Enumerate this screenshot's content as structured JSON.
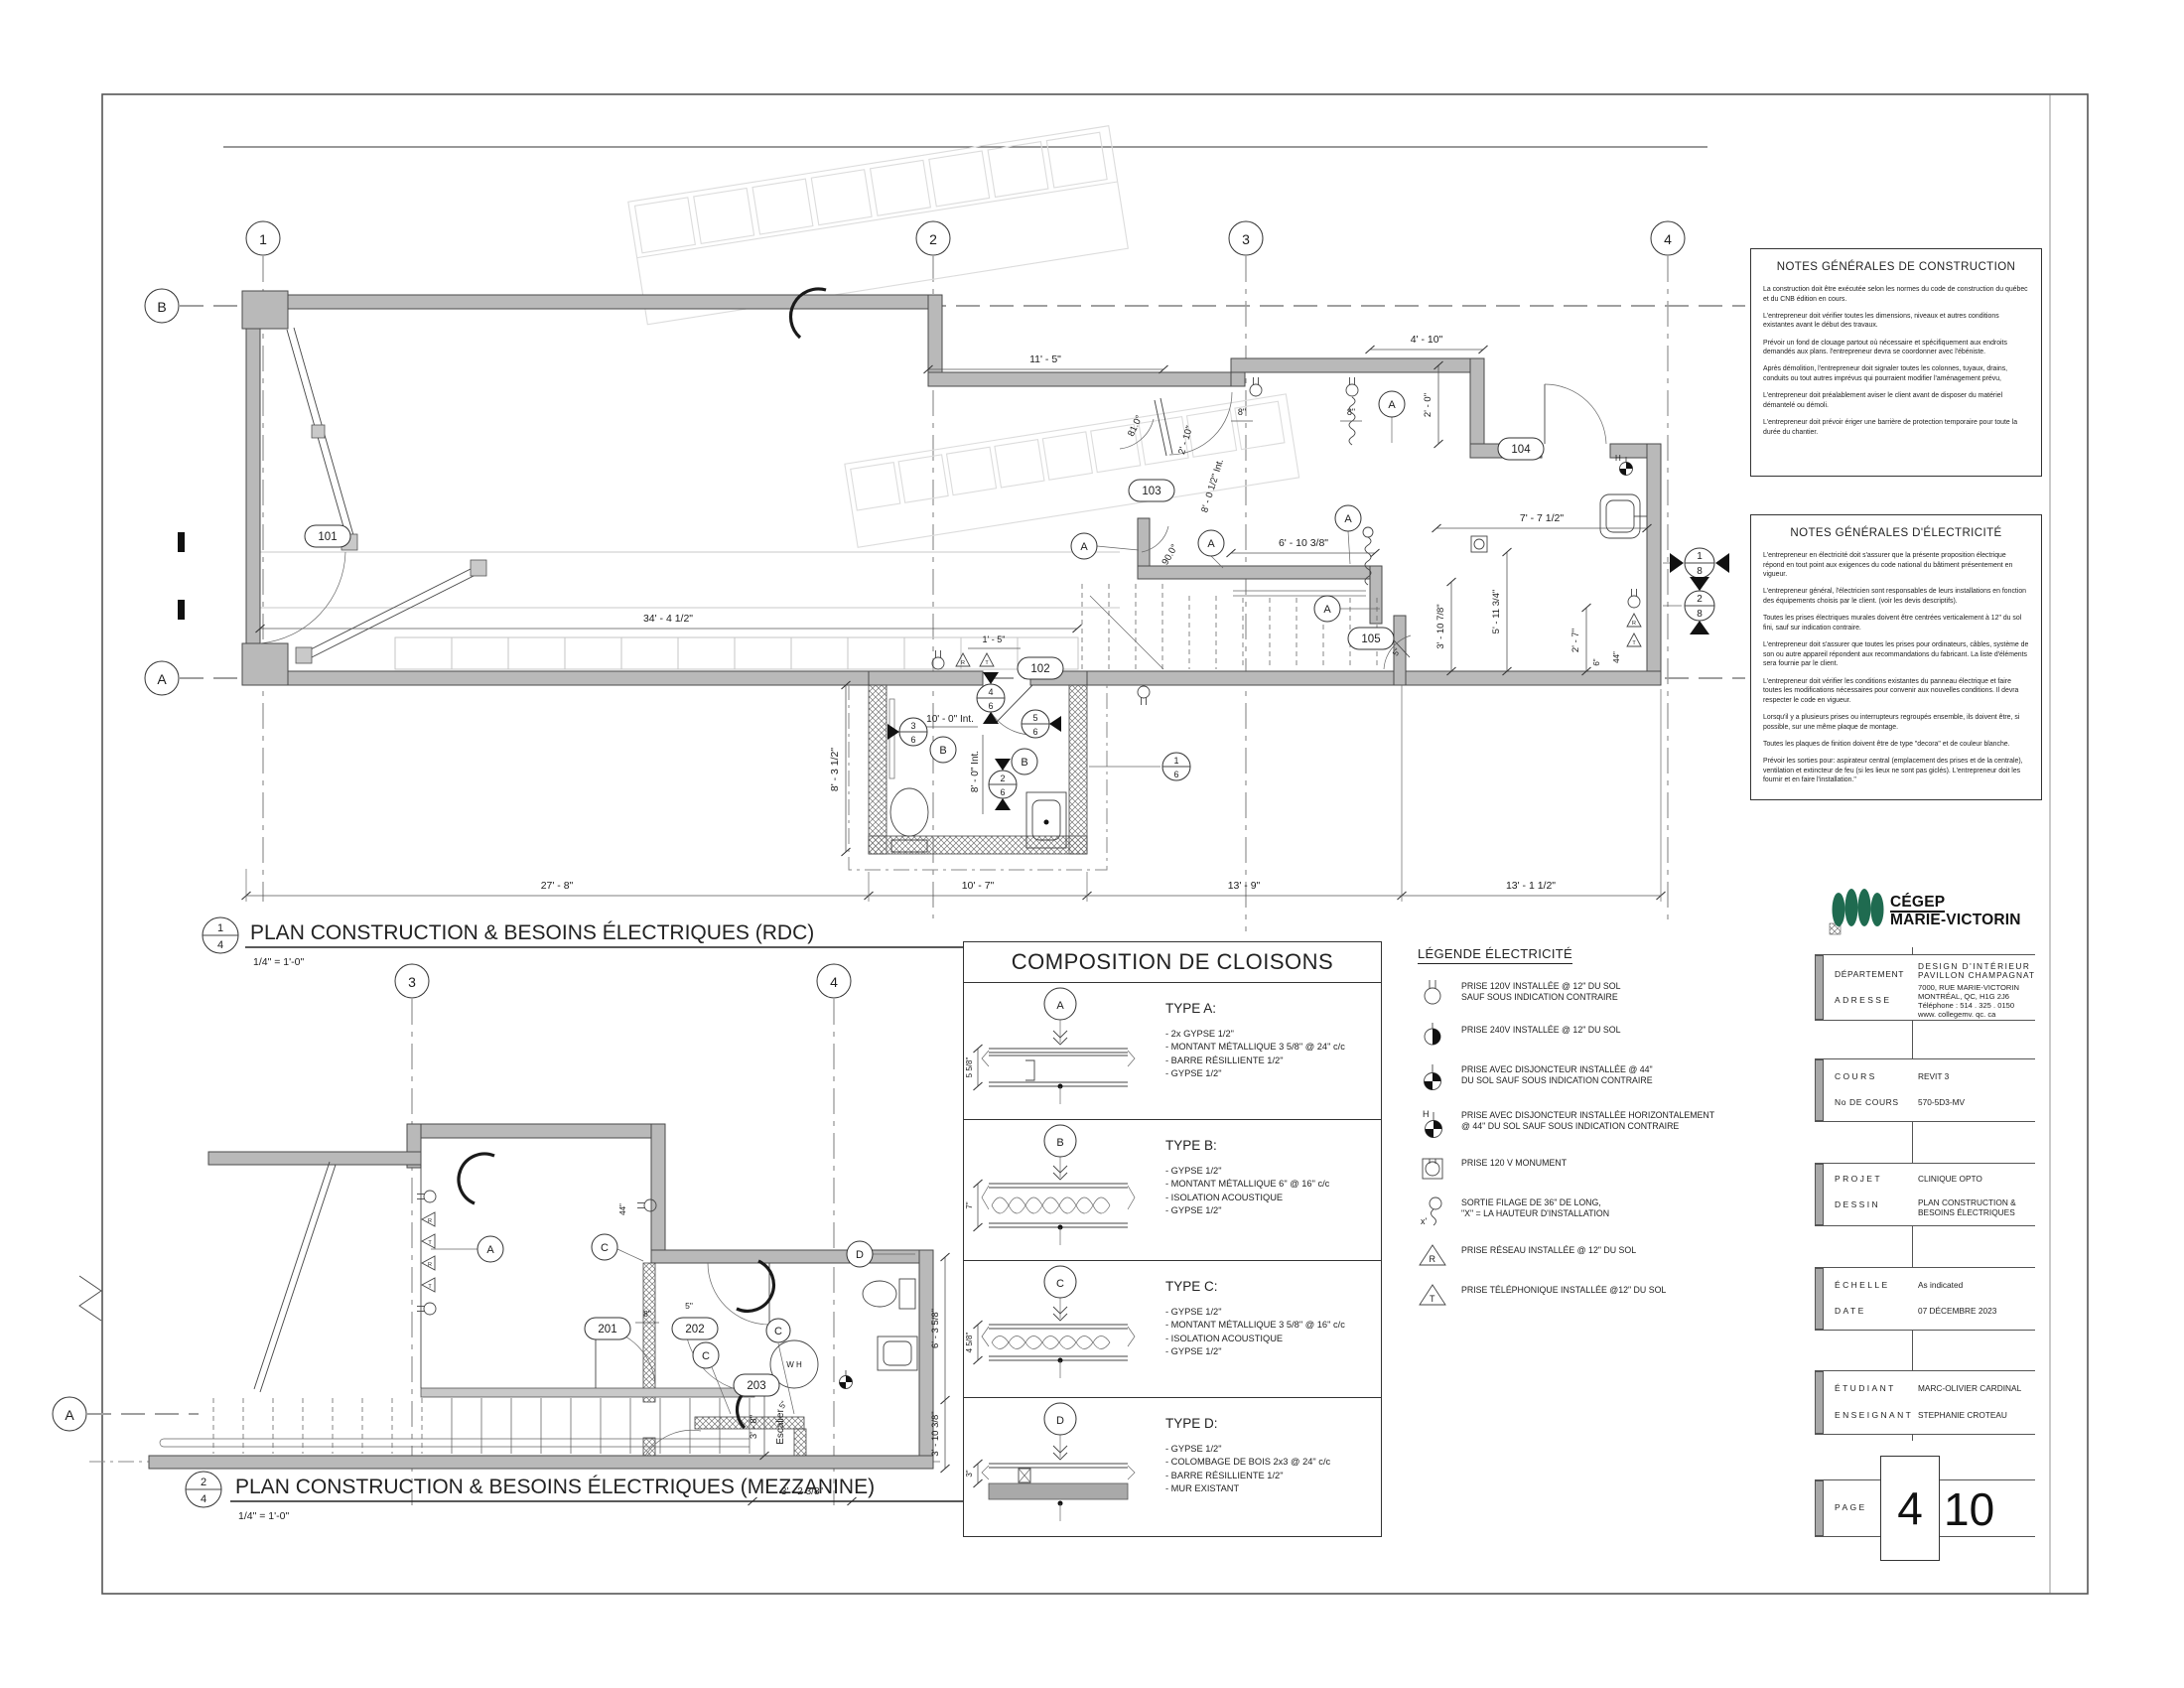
{
  "sheet": {
    "rdc_title": {
      "num": "1",
      "sheet": "4",
      "label": "PLAN CONSTRUCTION & BESOINS ÉLECTRIQUES (RDC)",
      "scale": "1/4\" = 1'-0\""
    },
    "mezz_title": {
      "num": "2",
      "sheet": "4",
      "label": "PLAN CONSTRUCTION & BESOINS ÉLECTRIQUES (MEZZANINE)",
      "scale": "1/4\" = 1'-0\""
    }
  },
  "grid": {
    "c1": "1",
    "c2": "2",
    "c3": "3",
    "c4": "4",
    "rb": "B",
    "ra": "A",
    "mc3": "3",
    "mc4": "4",
    "mra": "A"
  },
  "rdc": {
    "rooms": {
      "r101": "101",
      "r102": "102",
      "r103": "103",
      "r104": "104",
      "r105": "105"
    },
    "tags": {
      "a": "A",
      "b": "B"
    },
    "dims": {
      "w11_5": "11' - 5\"",
      "w4_10": "4' - 10\"",
      "h2_0": "2' - 0\"",
      "d8a": "8\"",
      "d8b": "8\"",
      "ang81": "81.0°",
      "w2_10": "2' - 10\"",
      "w8_0i": "8' - 0 1/2\" Int.",
      "ang90": "90.0°",
      "w6_10": "6' - 10 3/8\"",
      "w7_7": "7' - 7 1/2\"",
      "h5_11": "5' - 11 3/4\"",
      "h3_10": "3' - 10 7/8\"",
      "h2_7": "2' - 7\"",
      "d6": "6\"",
      "d44": "44\"",
      "d5": "5\"",
      "w34": "34' - 4 1/2\"",
      "w1_5": "1' - 5\"",
      "w10_0i": "10' - 0\" Int.",
      "h8_0i": "8' - 0\" Int.",
      "h8_3": "8' - 3 1/2\"",
      "b27": "27' - 8\"",
      "b10": "10' - 7\"",
      "b13a": "13' - 9\"",
      "b13b": "13' - 1 1/2\""
    },
    "details": {
      "m18t": "1",
      "m18b": "8",
      "m28t": "2",
      "m28b": "8",
      "m16t": "1",
      "m16b": "6",
      "m26t": "2",
      "m26b": "6",
      "m36t": "3",
      "m36b": "6",
      "m46t": "4",
      "m46b": "6",
      "m56t": "5",
      "m56b": "6"
    }
  },
  "mezz": {
    "rooms": {
      "r201": "201",
      "r202": "202",
      "r203": "203"
    },
    "tags": {
      "a": "A",
      "c": "C",
      "d": "D"
    },
    "labels": {
      "escalier": "Escalier",
      "wh": "W H"
    },
    "dims": {
      "d44": "44\"",
      "d8": "8\"",
      "d5a": "5\"",
      "d5b": "5\"",
      "h3_8": "3' - 8\"",
      "h6_3": "6' - 3 5/8\"",
      "h3_10": "3' - 10 3/8\"",
      "w3_2": "3' - 2 3/8\""
    }
  },
  "legend": {
    "title": "LÉGENDE ÉLECTRICITÉ",
    "sym_h": "H",
    "sym_x": "x'",
    "sym_r": "R",
    "sym_t": "T",
    "items": [
      {
        "l1": "PRISE 120V INSTALLÉE @ 12\" DU SOL",
        "l2": "SAUF SOUS INDICATION CONTRAIRE"
      },
      {
        "l1": "PRISE 240V INSTALLÉE @ 12\" DU SOL",
        "l2": ""
      },
      {
        "l1": "PRISE AVEC DISJONCTEUR INSTALLÉE @ 44\"",
        "l2": "DU SOL SAUF SOUS INDICATION CONTRAIRE"
      },
      {
        "l1": "PRISE AVEC DISJONCTEUR INSTALLÉE  HORIZONTALEMENT",
        "l2": "@ 44\" DU SOL SAUF SOUS INDICATION CONTRAIRE"
      },
      {
        "l1": "PRISE 120 V MONUMENT",
        "l2": ""
      },
      {
        "l1": "SORTIE FILAGE DE 36\" DE LONG,",
        "l2": "\"X\" = LA HAUTEUR D'INSTALLATION"
      },
      {
        "l1": "PRISE RÉSEAU  INSTALLÉE @ 12\" DU SOL",
        "l2": ""
      },
      {
        "l1": "PRISE TÉLÉPHONIQUE INSTALLÉE @12\" DU SOL",
        "l2": ""
      }
    ]
  },
  "cloisons": {
    "title": "COMPOSITION DE CLOISONS",
    "types": [
      {
        "letter": "A",
        "heading": "TYPE A:",
        "dim": "5 5/8\"",
        "i0": "- 2x GYPSE 1/2\"",
        "i1": "- MONTANT MÉTALLIQUE 3 5/8\" @ 24\" c/c",
        "i2": "- BARRE RÉSILLIENTE 1/2\"",
        "i3": "- GYPSE 1/2\""
      },
      {
        "letter": "B",
        "heading": "TYPE B:",
        "dim": "7\"",
        "i0": "- GYPSE 1/2\"",
        "i1": "- MONTANT MÉTALLIQUE 6\" @ 16\" c/c",
        "i2": "- ISOLATION ACOUSTIQUE",
        "i3": "- GYPSE 1/2\""
      },
      {
        "letter": "C",
        "heading": "TYPE C:",
        "dim": "4 5/8\"",
        "i0": "- GYPSE 1/2\"",
        "i1": "- MONTANT MÉTALLIQUE 3 5/8\" @ 16\" c/c",
        "i2": "- ISOLATION ACOUSTIQUE",
        "i3": "- GYPSE 1/2\""
      },
      {
        "letter": "D",
        "heading": "TYPE D:",
        "dim": "3\"",
        "i0": "- GYPSE 1/2\"",
        "i1": "- COLOMBAGE DE BOIS 2x3 @ 24\" c/c",
        "i2": "- BARRE RÉSILLIENTE 1/2\"",
        "i3": "- MUR EXISTANT"
      }
    ]
  },
  "notes_construction": {
    "title": "NOTES GÉNÉRALES DE CONSTRUCTION",
    "paragraphs": [
      "La construction doit être exécutée selon les normes du code de construction du québec et du CNB édition en cours.",
      "L'entrepreneur doit vérifier toutes les dimensions, niveaux et autres conditions existantes avant le début des travaux.",
      "Prévoir un fond de clouage partout où nécessaire et spécifiquement aux endroits demandés aux plans. l'entrepreneur devra se coordonner avec l'ébéniste.",
      "Après démolition, l'entrepreneur doit signaler toutes les colonnes, tuyaux, drains, conduits ou tout autres imprévus qui pourraient modifier l'aménagement prévu,",
      "L'entrepreneur doit préalablement aviser le client avant de disposer du matériel démantelé ou démoli.",
      "L'entrepreneur doit prévoir ériger une barrière de protection temporaire pour toute la durée du chantier."
    ]
  },
  "notes_electricite": {
    "title": "NOTES GÉNÉRALES D'ÉLECTRICITÉ",
    "paragraphs": [
      "L'entrepreneur en électricité doit s'assurer que la présente proposition électrique répond en tout point aux exigences du code national du bâtiment présentement en vigueur.",
      "L'entrepreneur général, l'électricien sont responsables de leurs installations en fonction des équipements choisis par le client. (voir les devis descriptifs).",
      "Toutes les prises électriques murales doivent être centrées verticalement à 12\" du sol fini, sauf sur indication contraire.",
      "L'entrepreneur doit s'assurer que toutes les prises pour ordinateurs, câbles, système de son ou autre appareil répondent aux recommandations du fabricant. La liste d'éléments sera fournie par le client.",
      "L'entrepreneur doit vérifier les conditions existantes du panneau électrique et faire toutes les modifications nécessaires pour convenir aux nouvelles conditions.  Il devra respecter le code en vigueur.",
      "Lorsqu'il y a plusieurs prises ou interrupteurs regroupés ensemble, ils doivent être, si possible, sur une même plaque de montage.",
      "Toutes les plaques de finition doivent être de type \"decora\" et de couleur blanche.",
      "Prévoir les sorties pour: aspirateur central (emplacement des prises et de la centrale), ventilation et extincteur de feu (si les lieux ne sont pas giclés). L'entrepreneur doit les fournir et en faire l'installation.\""
    ]
  },
  "titleblock": {
    "logo1": "CÉGEP",
    "logo2": "MARIE-VICTORIN",
    "logo_color": "#1f6b50",
    "departement_label": "DÉPARTEMENT",
    "departement_1": "DESIGN D'INTÉRIEUR",
    "departement_2": "PAVILLON   CHAMPAGNAT",
    "adresse_label": "ADRESSE",
    "adresse_1": "7000,  RUE  MARIE-VICTORIN",
    "adresse_2": "MONTRÉAL,  QC,  H1G 2J6",
    "adresse_3": "Téléphone :  514 . 325 . 0150",
    "adresse_4": "www. collegemv. qc. ca",
    "cours_label": "COURS",
    "cours": "REVIT 3",
    "no_cours_label": "No  DE  COURS",
    "no_cours": "570-5D3-MV",
    "projet_label": "PROJET",
    "projet": "CLINIQUE OPTO",
    "dessin_label": "DESSIN",
    "dessin_1": "PLAN CONSTRUCTION &",
    "dessin_2": "BESOINS ÉLECTRIQUES",
    "echelle_label": "ÉCHELLE",
    "echelle": "As indicated",
    "date_label": "DATE",
    "date": "07 DÉCEMBRE 2023",
    "etudiant_label": "ÉTUDIANT",
    "etudiant": "MARC-OLIVIER CARDINAL",
    "enseignant_label": "ENSEIGNANT",
    "enseignant": "STEPHANIE CROTEAU",
    "page_label": "PAGE",
    "page_number": "4",
    "page_total": "10"
  }
}
